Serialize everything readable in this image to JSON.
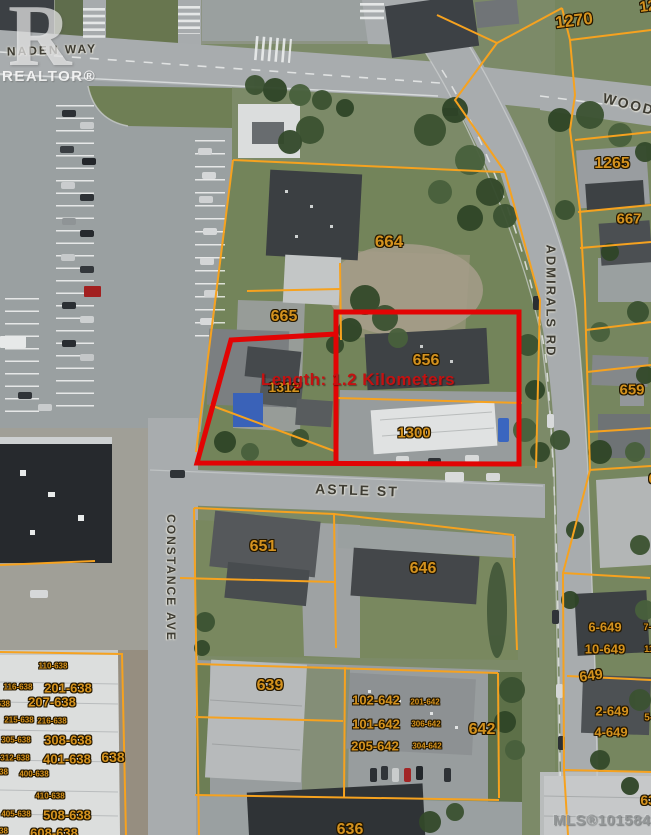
{
  "measurement": {
    "text": "Length: 1.2 Kilometers",
    "color": "#c41111"
  },
  "watermarks": {
    "logo_letter": "R",
    "logo_text": "REALTOR®",
    "mls_text": "MLS®1015842"
  },
  "colors": {
    "parcel_line": "#f6a21f",
    "highlight_line": "#e20404",
    "parcel_label": "#d4921e"
  },
  "street_labels": [
    {
      "text": "NADEN WAY",
      "x": 52,
      "y": 50,
      "rot": -2,
      "size": 12
    },
    {
      "text": "WOOD",
      "x": 629,
      "y": 104,
      "rot": 14,
      "size": 14
    },
    {
      "text": "ASTLE ST",
      "x": 357,
      "y": 490,
      "rot": 2,
      "size": 14
    },
    {
      "text": "CONSTANCE AVE",
      "x": 171,
      "y": 578,
      "rot": 90,
      "size": 12
    },
    {
      "text": "ADMIRALS RD",
      "x": 551,
      "y": 301,
      "rot": 90,
      "size": 13
    }
  ],
  "parcel_labels": [
    {
      "text": "1270",
      "x": 574,
      "y": 21,
      "size": 17,
      "rot": -7
    },
    {
      "text": "120",
      "x": 652,
      "y": 6,
      "size": 15,
      "rot": -7
    },
    {
      "text": "1265",
      "x": 612,
      "y": 164,
      "size": 16,
      "rot": 0
    },
    {
      "text": "667",
      "x": 629,
      "y": 219,
      "size": 15,
      "rot": 0
    },
    {
      "text": "664",
      "x": 389,
      "y": 242,
      "size": 17,
      "rot": 0
    },
    {
      "text": "665",
      "x": 284,
      "y": 317,
      "size": 16,
      "rot": 0
    },
    {
      "text": "656",
      "x": 426,
      "y": 361,
      "size": 16,
      "rot": 0
    },
    {
      "text": "1312",
      "x": 284,
      "y": 387,
      "size": 14,
      "rot": 0
    },
    {
      "text": "1300",
      "x": 414,
      "y": 433,
      "size": 15,
      "rot": 0
    },
    {
      "text": "659",
      "x": 632,
      "y": 390,
      "size": 15,
      "rot": 0
    },
    {
      "text": "657",
      "x": 661,
      "y": 479,
      "size": 15,
      "rot": 0
    },
    {
      "text": "651",
      "x": 263,
      "y": 547,
      "size": 16,
      "rot": 0
    },
    {
      "text": "646",
      "x": 423,
      "y": 569,
      "size": 16,
      "rot": 0
    },
    {
      "text": "639",
      "x": 270,
      "y": 686,
      "size": 16,
      "rot": 0
    },
    {
      "text": "642",
      "x": 482,
      "y": 730,
      "size": 16,
      "rot": 0
    },
    {
      "text": "636",
      "x": 350,
      "y": 830,
      "size": 16,
      "rot": 0
    },
    {
      "text": "649",
      "x": 591,
      "y": 675,
      "size": 14,
      "rot": -8
    },
    {
      "text": "6-649",
      "x": 605,
      "y": 627,
      "size": 13,
      "rot": 0
    },
    {
      "text": "7-649",
      "x": 655,
      "y": 627,
      "size": 9,
      "rot": 0
    },
    {
      "text": "10-649",
      "x": 605,
      "y": 649,
      "size": 13,
      "rot": 0
    },
    {
      "text": "11-649",
      "x": 658,
      "y": 649,
      "size": 9,
      "rot": 0
    },
    {
      "text": "2-649",
      "x": 612,
      "y": 711,
      "size": 13,
      "rot": 0
    },
    {
      "text": "5-649",
      "x": 657,
      "y": 718,
      "size": 10,
      "rot": 0
    },
    {
      "text": "4-649",
      "x": 611,
      "y": 732,
      "size": 13,
      "rot": 0
    },
    {
      "text": "639",
      "x": 652,
      "y": 800,
      "size": 14,
      "rot": 0
    },
    {
      "text": "110-638",
      "x": 53,
      "y": 666,
      "size": 8,
      "rot": 0
    },
    {
      "text": "116-638",
      "x": 18,
      "y": 687,
      "size": 8,
      "rot": 0
    },
    {
      "text": "201-638",
      "x": 68,
      "y": 688,
      "size": 13,
      "rot": 0
    },
    {
      "text": "-638",
      "x": 2,
      "y": 704,
      "size": 8,
      "rot": 0
    },
    {
      "text": "207-638",
      "x": 52,
      "y": 702,
      "size": 13,
      "rot": 0
    },
    {
      "text": "215-638",
      "x": 19,
      "y": 720,
      "size": 8,
      "rot": 0
    },
    {
      "text": "216-638",
      "x": 52,
      "y": 721,
      "size": 8,
      "rot": 0
    },
    {
      "text": "305-638",
      "x": 16,
      "y": 740,
      "size": 8,
      "rot": 0
    },
    {
      "text": "308-638",
      "x": 68,
      "y": 740,
      "size": 13,
      "rot": 0
    },
    {
      "text": "312-638",
      "x": 15,
      "y": 758,
      "size": 8,
      "rot": 0
    },
    {
      "text": "401-638",
      "x": 67,
      "y": 759,
      "size": 13,
      "rot": 0
    },
    {
      "text": "638",
      "x": 113,
      "y": 757,
      "size": 14,
      "rot": 0
    },
    {
      "text": "-638",
      "x": 0,
      "y": 772,
      "size": 8,
      "rot": 0
    },
    {
      "text": "400-638",
      "x": 34,
      "y": 774,
      "size": 8,
      "rot": 0
    },
    {
      "text": "410-638",
      "x": 50,
      "y": 796,
      "size": 8,
      "rot": 0
    },
    {
      "text": "405-638",
      "x": 16,
      "y": 814,
      "size": 8,
      "rot": 0
    },
    {
      "text": "508-638",
      "x": 67,
      "y": 815,
      "size": 13,
      "rot": 0
    },
    {
      "text": "-638",
      "x": 0,
      "y": 831,
      "size": 8,
      "rot": 0
    },
    {
      "text": "608-638",
      "x": 54,
      "y": 833,
      "size": 13,
      "rot": 0
    },
    {
      "text": "102-642",
      "x": 376,
      "y": 700,
      "size": 13,
      "rot": 0
    },
    {
      "text": "201-642",
      "x": 425,
      "y": 702,
      "size": 8,
      "rot": 0
    },
    {
      "text": "101-642",
      "x": 376,
      "y": 724,
      "size": 13,
      "rot": 0
    },
    {
      "text": "306-642",
      "x": 426,
      "y": 724,
      "size": 8,
      "rot": 0
    },
    {
      "text": "205-642",
      "x": 375,
      "y": 746,
      "size": 13,
      "rot": 0
    },
    {
      "text": "304-642",
      "x": 427,
      "y": 746,
      "size": 8,
      "rot": 0
    }
  ]
}
